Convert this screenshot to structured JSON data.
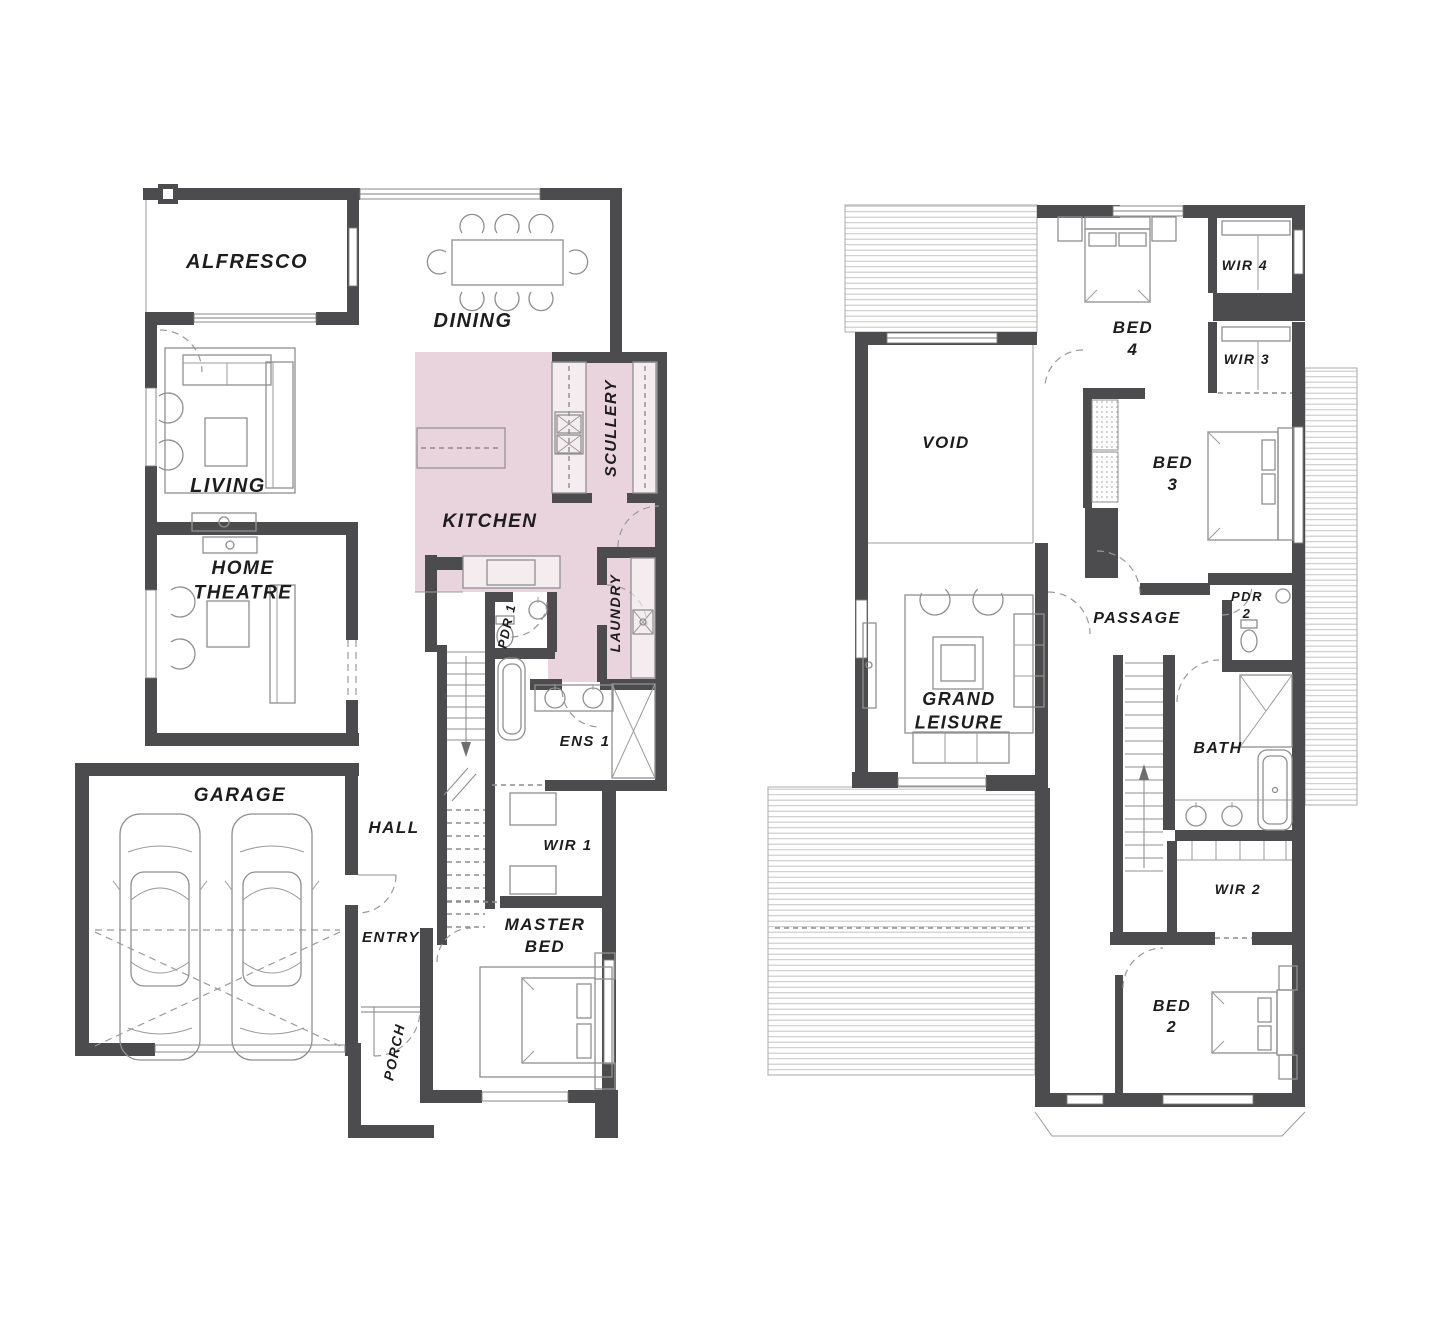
{
  "document": {
    "kind": "architectural-floor-plan",
    "floors": [
      "ground",
      "first"
    ],
    "highlighted_rooms": [
      "KITCHEN",
      "SCULLERY",
      "LAUNDRY"
    ]
  },
  "colors": {
    "highlight": "#e9d4dd",
    "wall": "#4c4c4e",
    "furniture_line": "#8f8f8f",
    "hatch": "#c9c9c9",
    "ink": "#1d1d1d",
    "background": "#ffffff"
  },
  "floors": {
    "ground": {
      "rooms": [
        {
          "id": "alfresco",
          "lines": [
            "ALFRESCO"
          ],
          "x": 247,
          "y": 268,
          "size": 20,
          "rot": 0
        },
        {
          "id": "dining",
          "lines": [
            "DINING"
          ],
          "x": 473,
          "y": 327,
          "size": 20,
          "rot": 0
        },
        {
          "id": "living",
          "lines": [
            "LIVING"
          ],
          "x": 228,
          "y": 492,
          "size": 20,
          "rot": 0
        },
        {
          "id": "home-theatre",
          "lines": [
            "HOME",
            "THEATRE"
          ],
          "x": 243,
          "y": 574,
          "size": 19,
          "rot": 0
        },
        {
          "id": "kitchen",
          "lines": [
            "KITCHEN"
          ],
          "x": 490,
          "y": 527,
          "size": 19,
          "rot": 0
        },
        {
          "id": "scullery",
          "lines": [
            "SCULLERY"
          ],
          "x": 616,
          "y": 428,
          "size": 16,
          "rot": -90
        },
        {
          "id": "laundry",
          "lines": [
            "LAUNDRY"
          ],
          "x": 620,
          "y": 613,
          "size": 14,
          "rot": -90
        },
        {
          "id": "pdr-1",
          "lines": [
            "PDR 1"
          ],
          "x": 511,
          "y": 627,
          "size": 13,
          "rot": -78
        },
        {
          "id": "ens-1",
          "lines": [
            "ENS 1"
          ],
          "x": 585,
          "y": 746,
          "size": 15,
          "rot": 0
        },
        {
          "id": "hall",
          "lines": [
            "HALL"
          ],
          "x": 394,
          "y": 833,
          "size": 17,
          "rot": 0
        },
        {
          "id": "wir-1",
          "lines": [
            "WIR 1"
          ],
          "x": 568,
          "y": 850,
          "size": 15,
          "rot": 0
        },
        {
          "id": "garage",
          "lines": [
            "GARAGE"
          ],
          "x": 240,
          "y": 801,
          "size": 19,
          "rot": 0
        },
        {
          "id": "entry",
          "lines": [
            "ENTRY"
          ],
          "x": 391,
          "y": 942,
          "size": 15,
          "rot": 0
        },
        {
          "id": "porch",
          "lines": [
            "PORCH"
          ],
          "x": 399,
          "y": 1053,
          "size": 14,
          "rot": -78
        },
        {
          "id": "master-bed",
          "lines": [
            "MASTER",
            "BED"
          ],
          "x": 545,
          "y": 930,
          "size": 17,
          "rot": 0
        }
      ]
    },
    "first": {
      "rooms": [
        {
          "id": "wir-4",
          "lines": [
            "WIR 4"
          ],
          "x": 1245,
          "y": 270,
          "size": 14,
          "rot": 0
        },
        {
          "id": "bed-4",
          "lines": [
            "BED",
            "4"
          ],
          "x": 1133,
          "y": 333,
          "size": 17,
          "rot": 0
        },
        {
          "id": "wir-3",
          "lines": [
            "WIR 3"
          ],
          "x": 1247,
          "y": 364,
          "size": 14,
          "rot": 0
        },
        {
          "id": "void",
          "lines": [
            "VOID"
          ],
          "x": 946,
          "y": 448,
          "size": 17,
          "rot": 0
        },
        {
          "id": "bed-3",
          "lines": [
            "BED",
            "3"
          ],
          "x": 1173,
          "y": 468,
          "size": 17,
          "rot": 0
        },
        {
          "id": "passage",
          "lines": [
            "PASSAGE"
          ],
          "x": 1137,
          "y": 623,
          "size": 16,
          "rot": 0
        },
        {
          "id": "pdr-2",
          "lines": [
            "PDR",
            "2"
          ],
          "x": 1247,
          "y": 601,
          "size": 13,
          "rot": 0
        },
        {
          "id": "grand-leisure",
          "lines": [
            "GRAND",
            "LEISURE"
          ],
          "x": 959,
          "y": 705,
          "size": 18,
          "rot": 0
        },
        {
          "id": "bath",
          "lines": [
            "BATH"
          ],
          "x": 1218,
          "y": 753,
          "size": 16,
          "rot": 0
        },
        {
          "id": "wir-2",
          "lines": [
            "WIR 2"
          ],
          "x": 1238,
          "y": 894,
          "size": 14,
          "rot": 0
        },
        {
          "id": "bed-2",
          "lines": [
            "BED",
            "2"
          ],
          "x": 1172,
          "y": 1011,
          "size": 16,
          "rot": 0
        }
      ]
    }
  }
}
